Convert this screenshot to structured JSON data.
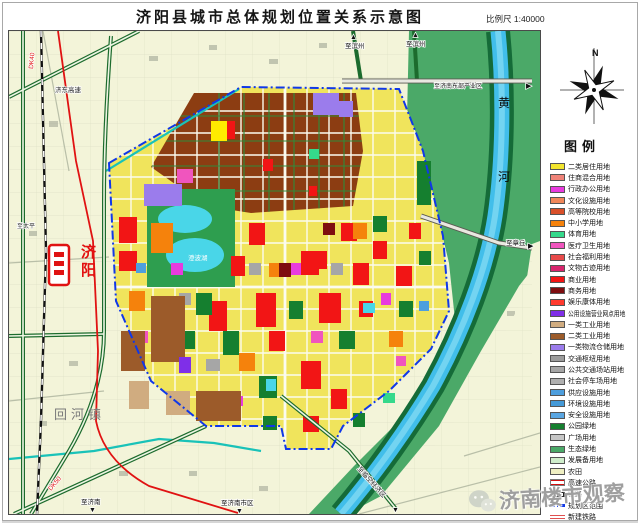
{
  "title": "济阳县城市总体规划位置关系示意图",
  "scale_label": "比例尺 1:40000",
  "compass": {
    "north_label": "N"
  },
  "watermark": {
    "text": "济南楼市观察",
    "icon": "wechat-icon"
  },
  "legend": {
    "title": "图例",
    "items": [
      {
        "label": "二类居住用地",
        "type": "fill",
        "color": "#F2E52E"
      },
      {
        "label": "住商混合用地",
        "type": "fill",
        "color": "#EF8378"
      },
      {
        "label": "行政办公用地",
        "type": "fill",
        "color": "#E83BDE"
      },
      {
        "label": "文化设施用地",
        "type": "fill",
        "color": "#F0875A"
      },
      {
        "label": "高等院校用地",
        "type": "fill",
        "color": "#D9502A"
      },
      {
        "label": "中小学用地",
        "type": "fill",
        "color": "#F5820C"
      },
      {
        "label": "体育用地",
        "type": "fill",
        "color": "#35D98B"
      },
      {
        "label": "医疗卫生用地",
        "type": "fill",
        "color": "#F055BE"
      },
      {
        "label": "社会福利用地",
        "type": "fill",
        "color": "#E84B4B"
      },
      {
        "label": "文物古迹用地",
        "type": "fill",
        "color": "#D8256E"
      },
      {
        "label": "商业用地",
        "type": "fill",
        "color": "#F21515"
      },
      {
        "label": "商务用地",
        "type": "fill",
        "color": "#7E0E10"
      },
      {
        "label": "娱乐康体用地",
        "type": "fill",
        "color": "#FF3A2E"
      },
      {
        "label": "公用设施营业网点用地",
        "type": "fill",
        "color": "#7F2FE8"
      },
      {
        "label": "一类工业用地",
        "type": "fill",
        "color": "#D0AC80"
      },
      {
        "label": "二类工业用地",
        "type": "fill",
        "color": "#9C5B2A"
      },
      {
        "label": "一类物流仓储用地",
        "type": "fill",
        "color": "#9B7CEC"
      },
      {
        "label": "交通枢纽用地",
        "type": "fill",
        "color": "#9C9C9C"
      },
      {
        "label": "公共交通场站用地",
        "type": "fill",
        "color": "#A6A6A6"
      },
      {
        "label": "社会停车场用地",
        "type": "fill",
        "color": "#B0B0B0"
      },
      {
        "label": "供应设施用地",
        "type": "fill",
        "color": "#4E9FDE"
      },
      {
        "label": "环境设施用地",
        "type": "fill",
        "color": "#459AD8"
      },
      {
        "label": "安全设施用地",
        "type": "fill",
        "color": "#5AA6E2"
      },
      {
        "label": "公园绿地",
        "type": "fill",
        "color": "#157F2F"
      },
      {
        "label": "广场用地",
        "type": "fill",
        "color": "#C6C6C6"
      },
      {
        "label": "生态绿地",
        "type": "fill",
        "color": "#4BA968"
      },
      {
        "label": "发展备用地",
        "type": "fill",
        "color": "#CFEDCB"
      },
      {
        "label": "农田",
        "type": "fill",
        "color": "#EFEFC2"
      },
      {
        "label": "高速公路",
        "type": "expressway",
        "color": "#D01010"
      },
      {
        "label": "铁路",
        "type": "railway",
        "color": "#000000"
      },
      {
        "label": "规划区范围",
        "type": "boundary",
        "color": "#1038E8"
      },
      {
        "label": "新建铁路",
        "type": "new-railway",
        "color": "#E05050"
      }
    ]
  },
  "map": {
    "colors": {
      "cm": "#F21515",
      "pk": "#157F2F",
      "sc": "#F5820C",
      "ad": "#E83BDE",
      "md": "#F055BE",
      "gy": "#A6A6A6",
      "i2": "#9C5B2A",
      "i1": "#D0AC80",
      "lg": "#9B7CEC",
      "bz": "#7E0E10",
      "ut": "#4E9FDE",
      "y2": "#FFEB00",
      "sp": "#35D98B",
      "wa": "#49D6E8",
      "pu": "#7F2FE8"
    },
    "labels": [
      {
        "text": "黄河",
        "x": 489,
        "y": 76,
        "size": 12,
        "color": "#0a0a0a",
        "vertical": true,
        "gap": 74
      },
      {
        "text": "济阳",
        "x": 72,
        "y": 226,
        "size": 15,
        "color": "#E21010",
        "bold": true,
        "vertical": true,
        "gap": 18
      },
      {
        "text": "回河镇",
        "x": 45,
        "y": 388,
        "size": 13,
        "color": "#7a7a7a",
        "spacing": 4
      },
      {
        "text": "澄波湖",
        "x": 179,
        "y": 229,
        "size": 6.5,
        "color": "#ffffff"
      },
      {
        "text": "济东高速",
        "x": 46,
        "y": 61,
        "size": 6.5,
        "color": "#222222"
      },
      {
        "text": "至滨州",
        "x": 336,
        "y": 17,
        "size": 6.5,
        "color": "#111111"
      },
      {
        "text": "▲",
        "x": 341,
        "y": 8,
        "size": 7,
        "color": "#111111"
      },
      {
        "text": "至滨州",
        "x": 397,
        "y": 15,
        "size": 6.5,
        "color": "#111111"
      },
      {
        "text": "▲",
        "x": 403,
        "y": 6,
        "size": 7,
        "color": "#111111"
      },
      {
        "text": "至济南东部产业区",
        "x": 425,
        "y": 57,
        "size": 6,
        "color": "#111111"
      },
      {
        "text": "▶",
        "x": 517,
        "y": 57,
        "size": 7,
        "color": "#111111"
      },
      {
        "text": "至章丘",
        "x": 497,
        "y": 214,
        "size": 6.5,
        "color": "#111111"
      },
      {
        "text": "▶",
        "x": 519,
        "y": 217,
        "size": 7,
        "color": "#111111"
      },
      {
        "text": "至济南",
        "x": 72,
        "y": 473,
        "size": 6.5,
        "color": "#111111"
      },
      {
        "text": "▼",
        "x": 80,
        "y": 481,
        "size": 7,
        "color": "#111111"
      },
      {
        "text": "至济南市区",
        "x": 212,
        "y": 474,
        "size": 6.5,
        "color": "#111111"
      },
      {
        "text": "▼",
        "x": 227,
        "y": 482,
        "size": 7,
        "color": "#111111"
      },
      {
        "text": "至临空经济区",
        "x": 348,
        "y": 438,
        "size": 6.5,
        "color": "#111111",
        "rotate": 48
      },
      {
        "text": "▼",
        "x": 383,
        "y": 481,
        "size": 7,
        "color": "#111111"
      },
      {
        "text": "至太平",
        "x": 8,
        "y": 197,
        "size": 6,
        "color": "#333333"
      },
      {
        "text": "DK40",
        "x": 24,
        "y": 38,
        "size": 6.5,
        "color": "#E01212",
        "rotate": -85
      },
      {
        "text": "DK50",
        "x": 42,
        "y": 460,
        "size": 6.5,
        "color": "#E01212",
        "rotate": -50
      }
    ],
    "blocks": [
      [
        110,
        186,
        18,
        26,
        "cm"
      ],
      [
        110,
        220,
        18,
        20,
        "cm"
      ],
      [
        152,
        270,
        22,
        26,
        "cm"
      ],
      [
        200,
        270,
        18,
        30,
        "cm"
      ],
      [
        222,
        225,
        14,
        20,
        "cm"
      ],
      [
        240,
        192,
        16,
        22,
        "cm"
      ],
      [
        247,
        262,
        20,
        34,
        "cm"
      ],
      [
        292,
        220,
        18,
        24,
        "cm"
      ],
      [
        310,
        262,
        22,
        30,
        "cm"
      ],
      [
        304,
        220,
        14,
        18,
        "cm"
      ],
      [
        332,
        192,
        16,
        18,
        "cm"
      ],
      [
        344,
        232,
        16,
        22,
        "cm"
      ],
      [
        364,
        210,
        14,
        18,
        "cm"
      ],
      [
        387,
        235,
        16,
        20,
        "cm"
      ],
      [
        292,
        330,
        20,
        28,
        "cm"
      ],
      [
        260,
        300,
        16,
        20,
        "cm"
      ],
      [
        322,
        358,
        16,
        20,
        "cm"
      ],
      [
        294,
        385,
        16,
        16,
        "cm"
      ],
      [
        350,
        270,
        14,
        16,
        "cm"
      ],
      [
        400,
        192,
        12,
        16,
        "cm"
      ],
      [
        218,
        90,
        8,
        18,
        "cm"
      ],
      [
        254,
        128,
        10,
        12,
        "cm"
      ],
      [
        300,
        155,
        8,
        10,
        "cm"
      ],
      [
        187,
        262,
        16,
        22,
        "pk"
      ],
      [
        214,
        300,
        16,
        24,
        "pk"
      ],
      [
        250,
        345,
        18,
        22,
        "pk"
      ],
      [
        280,
        270,
        14,
        18,
        "pk"
      ],
      [
        330,
        300,
        16,
        18,
        "pk"
      ],
      [
        364,
        185,
        14,
        16,
        "pk"
      ],
      [
        390,
        270,
        14,
        16,
        "pk"
      ],
      [
        254,
        385,
        14,
        14,
        "pk"
      ],
      [
        172,
        300,
        14,
        18,
        "pk"
      ],
      [
        410,
        220,
        12,
        14,
        "pk"
      ],
      [
        344,
        382,
        12,
        14,
        "pk"
      ],
      [
        408,
        130,
        14,
        44,
        "pk"
      ],
      [
        142,
        192,
        22,
        30,
        "sc"
      ],
      [
        120,
        260,
        16,
        20,
        "sc"
      ],
      [
        230,
        322,
        16,
        18,
        "sc"
      ],
      [
        344,
        192,
        14,
        16,
        "sc"
      ],
      [
        380,
        300,
        14,
        16,
        "sc"
      ],
      [
        260,
        232,
        12,
        14,
        "sc"
      ],
      [
        162,
        232,
        12,
        12,
        "ad"
      ],
      [
        282,
        232,
        10,
        12,
        "ad"
      ],
      [
        372,
        262,
        10,
        12,
        "ad"
      ],
      [
        224,
        365,
        10,
        10,
        "ad"
      ],
      [
        127,
        300,
        12,
        12,
        "md"
      ],
      [
        302,
        300,
        12,
        12,
        "md"
      ],
      [
        387,
        325,
        10,
        10,
        "md"
      ],
      [
        168,
        138,
        16,
        14,
        "md"
      ],
      [
        170,
        262,
        12,
        12,
        "gy"
      ],
      [
        240,
        232,
        12,
        12,
        "gy"
      ],
      [
        322,
        232,
        12,
        12,
        "gy"
      ],
      [
        197,
        328,
        14,
        12,
        "gy"
      ],
      [
        142,
        265,
        34,
        66,
        "i2"
      ],
      [
        187,
        360,
        45,
        30,
        "i2"
      ],
      [
        112,
        300,
        24,
        40,
        "i2"
      ],
      [
        120,
        350,
        20,
        28,
        "i1"
      ],
      [
        157,
        360,
        24,
        24,
        "i1"
      ],
      [
        270,
        232,
        12,
        14,
        "bz"
      ],
      [
        314,
        192,
        12,
        12,
        "bz"
      ],
      [
        170,
        326,
        12,
        16,
        "pu"
      ],
      [
        304,
        62,
        26,
        22,
        "lg"
      ],
      [
        330,
        70,
        14,
        16,
        "lg"
      ],
      [
        135,
        153,
        38,
        22,
        "lg"
      ],
      [
        410,
        270,
        10,
        10,
        "ut"
      ],
      [
        127,
        232,
        10,
        10,
        "ut"
      ],
      [
        202,
        90,
        16,
        20,
        "y2"
      ],
      [
        300,
        118,
        10,
        10,
        "sp"
      ],
      [
        374,
        362,
        12,
        10,
        "sp"
      ],
      [
        354,
        272,
        12,
        10,
        "wa"
      ],
      [
        257,
        348,
        10,
        12,
        "wa"
      ]
    ]
  }
}
